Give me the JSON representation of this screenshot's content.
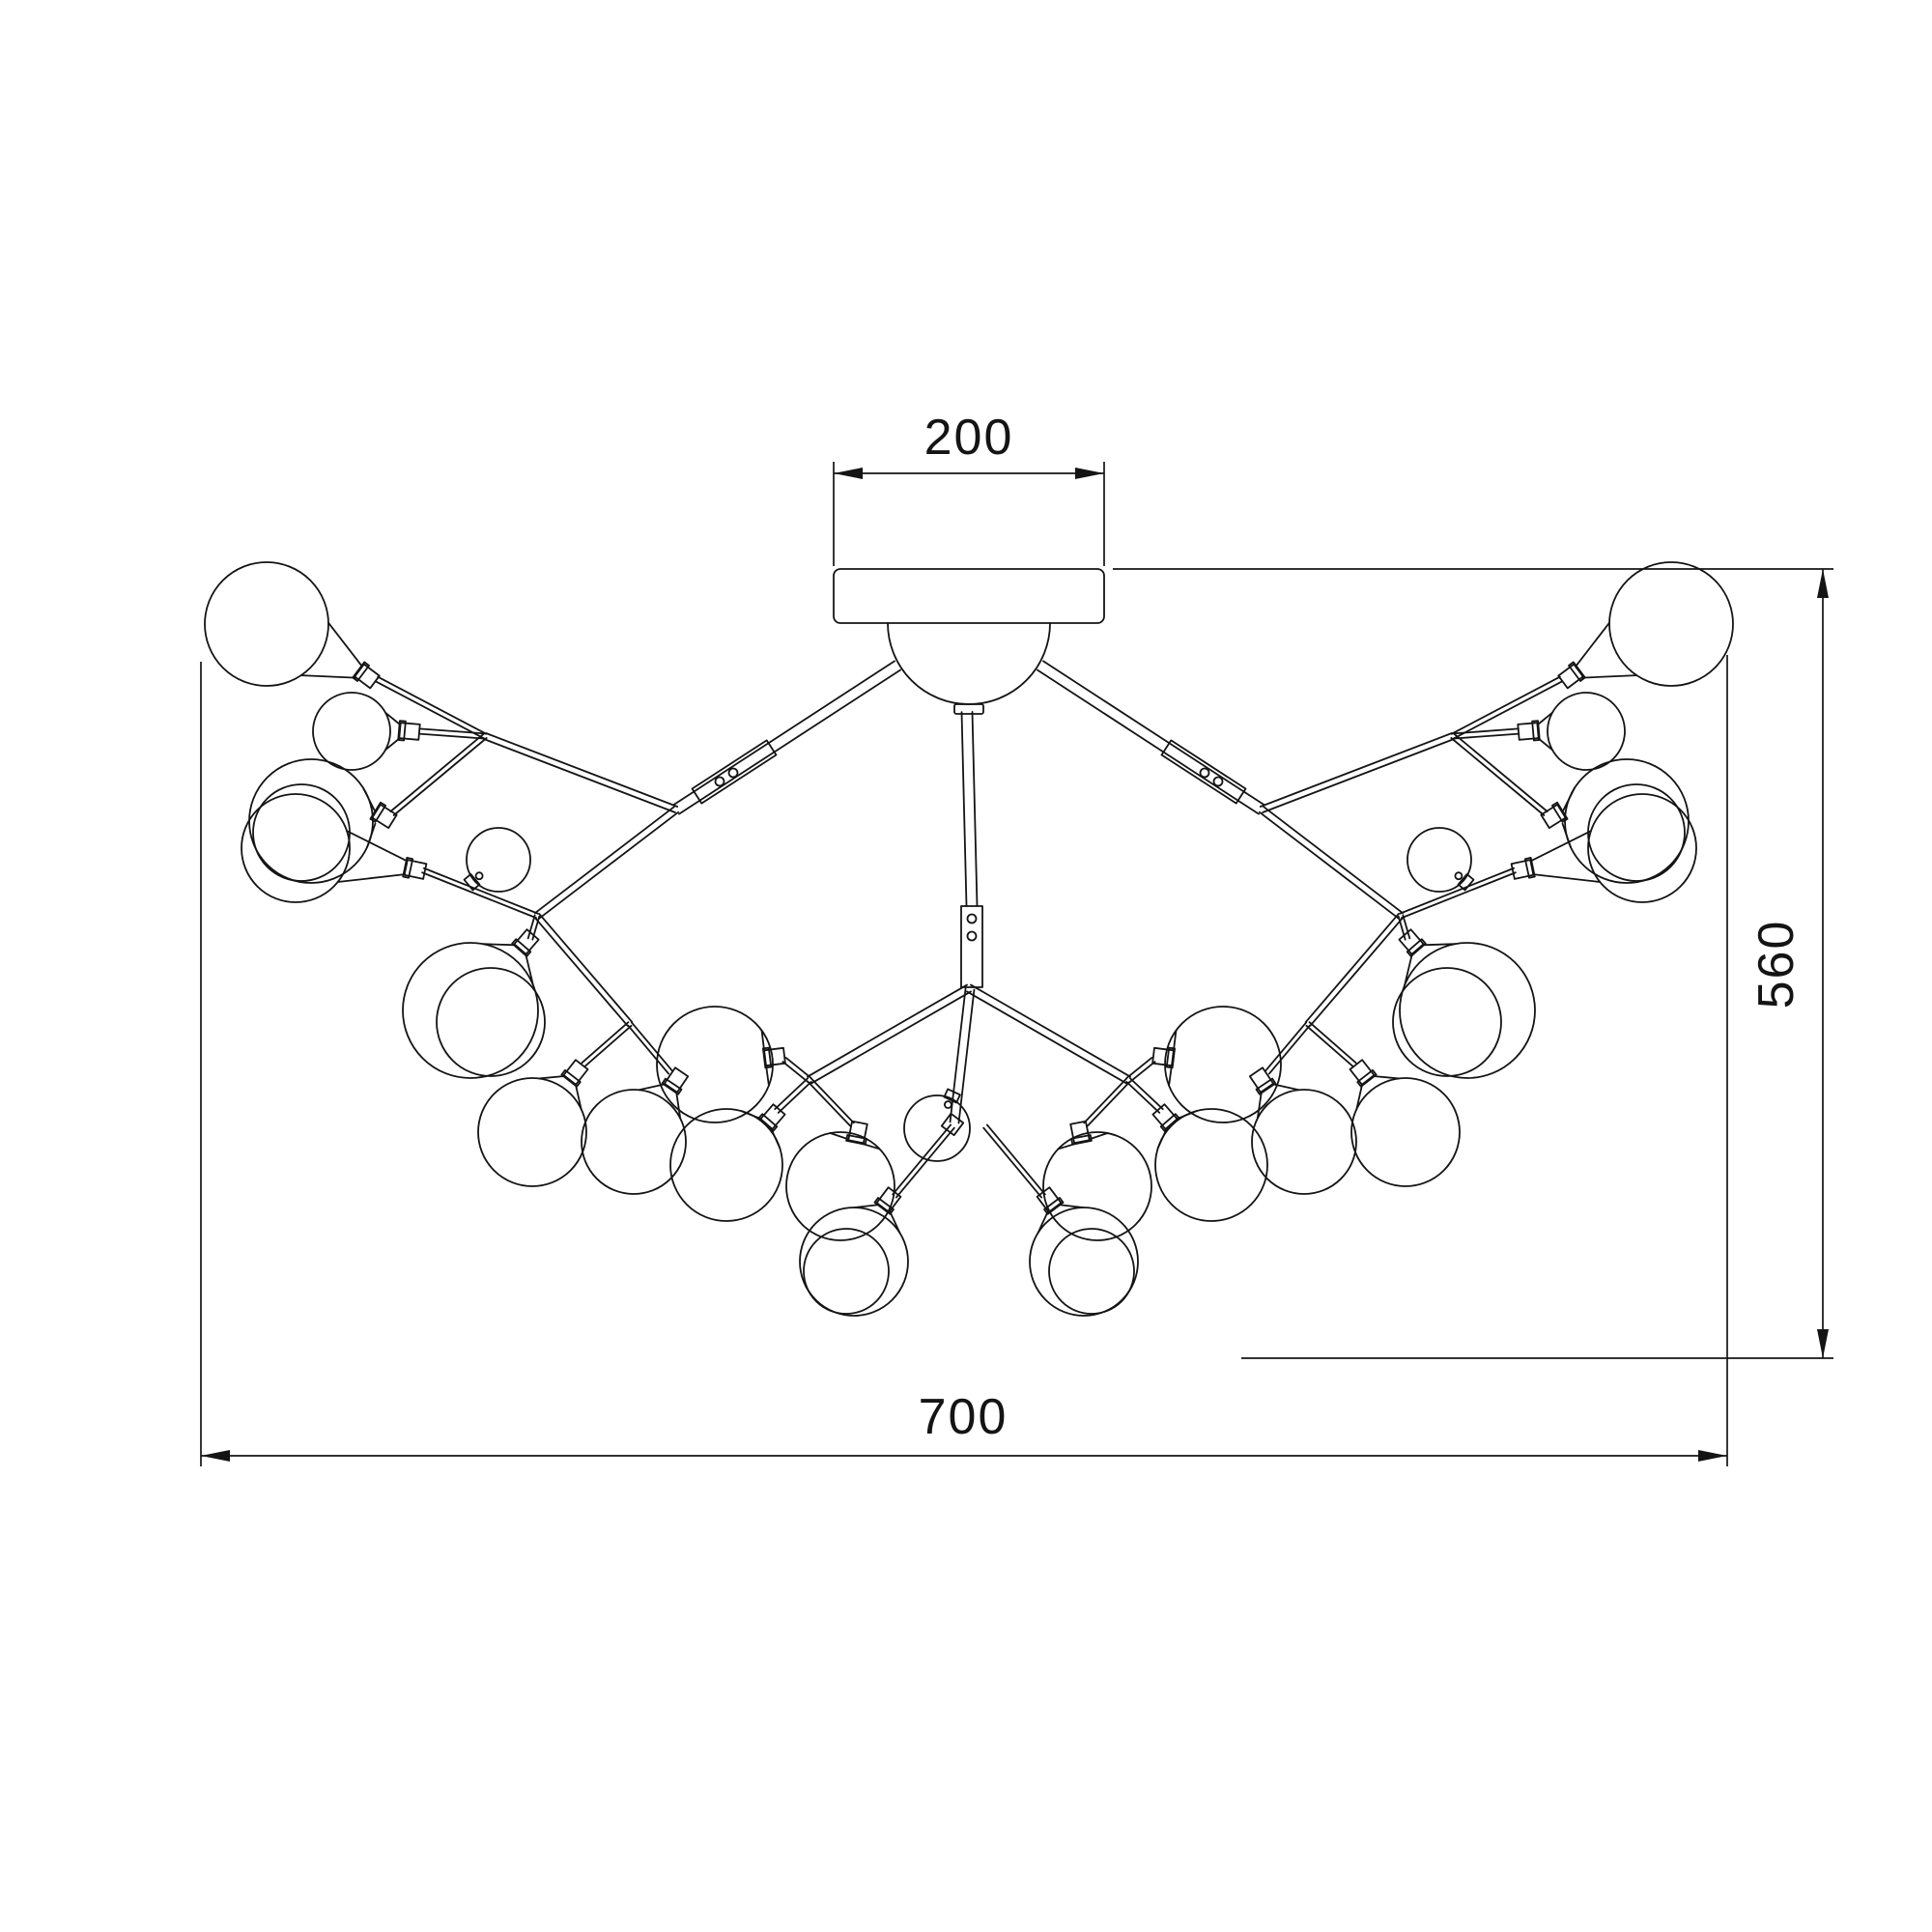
{
  "drawing": {
    "type": "technical-dimension-drawing",
    "subject": "branching chandelier ceiling fixture (top/front elevation)",
    "line_color": "#141414",
    "background": "#ffffff",
    "dimensions": {
      "canopy_width": "200",
      "overall_height": "560",
      "overall_width": "700"
    }
  }
}
